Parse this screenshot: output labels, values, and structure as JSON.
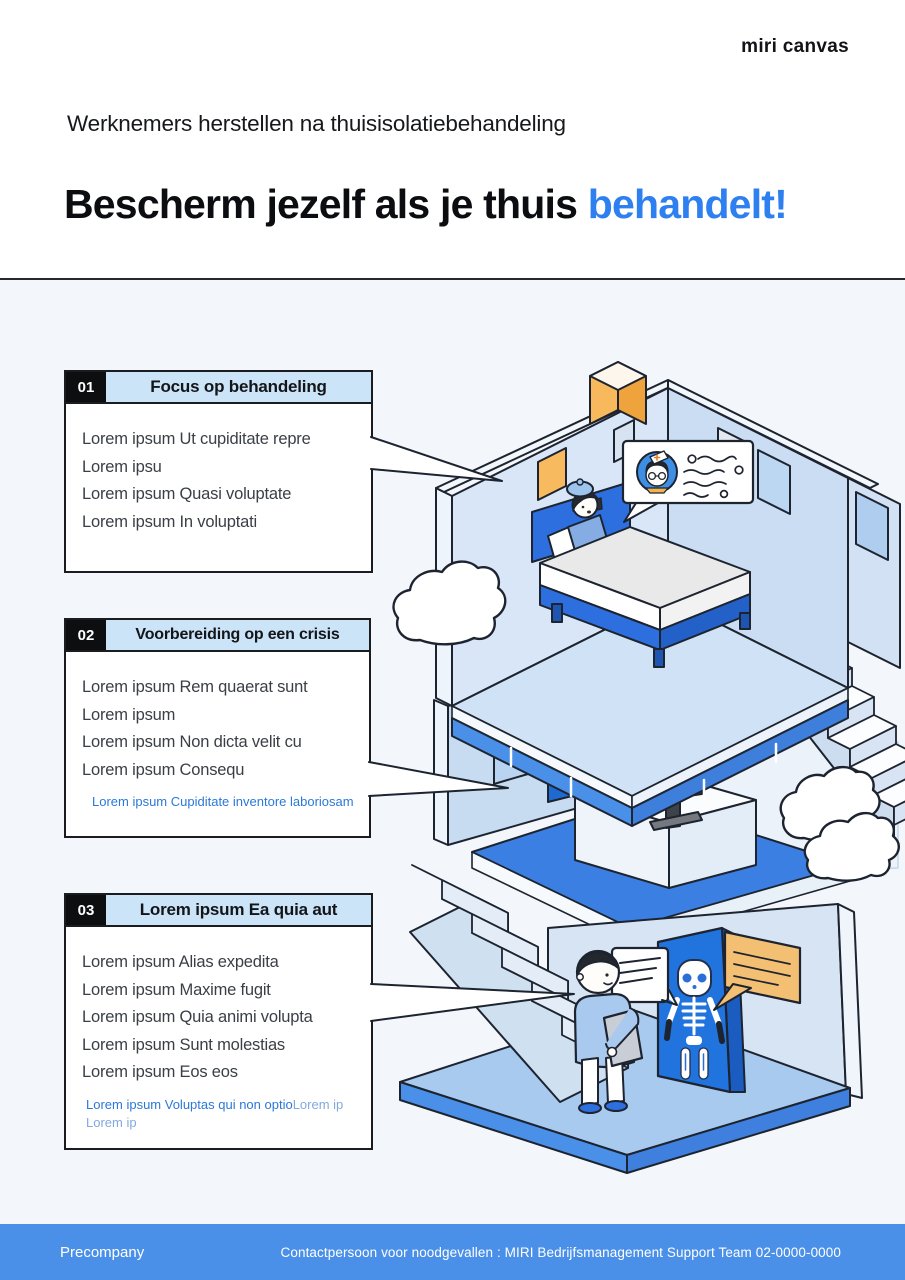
{
  "logo": "miri canvas",
  "header": {
    "kicker": "Werknemers herstellen na thuisisolatiebehandeling",
    "title_main": "Bescherm jezelf als je thuis ",
    "title_accent": "behandelt!"
  },
  "sections": [
    {
      "number": "01",
      "title": "Focus op behandeling",
      "lines": [
        "Lorem ipsum Ut cupiditate repre",
        "Lorem ipsu",
        "Lorem ipsum Quasi voluptate",
        "Lorem ipsum In voluptati"
      ]
    },
    {
      "number": "02",
      "title": "Voorbereiding op een crisis",
      "lines": [
        "Lorem ipsum Rem quaerat sunt",
        "Lorem ipsum",
        "Lorem ipsum Non dicta velit cu",
        "Lorem ipsum Consequ"
      ],
      "link": "Lorem ipsum Cupiditate inventore laboriosam"
    },
    {
      "number": "03",
      "title": "Lorem ipsum Ea quia aut",
      "lines": [
        "Lorem ipsum Alias expedita",
        "Lorem ipsum Maxime fugit",
        "Lorem ipsum Quia animi volupta",
        "Lorem ipsum Sunt molestias",
        "Lorem ipsum Eos eos"
      ],
      "link": "Lorem ipsum Voluptas qui non optio",
      "link_light": "Lorem ip",
      "link_light2": "Lorem ip"
    }
  ],
  "footer": {
    "company": "Precompany",
    "contact": "Contactpersoon voor noodgevallen : MIRI Bedrijfsmanagement Support Team 02-0000-0000"
  },
  "colors": {
    "accent_blue": "#2e7ff0",
    "footer_blue": "#4a90e8",
    "callout_header_bg": "#cbe4f8",
    "link_blue": "#2b78d8",
    "stage_bg": "#f3f6fa",
    "illustration_blue": "#2173de",
    "illustration_orange": "#f7ba5e"
  },
  "illustration": {
    "scene": "isometric-house-cutaway-three-floors",
    "floor_top": "patient-in-bed-telehealth-call-with-nurse",
    "floor_middle": "person-working-at-computer-desk",
    "floor_bottom": "person-with-tablet-viewing-xray-skeleton"
  }
}
